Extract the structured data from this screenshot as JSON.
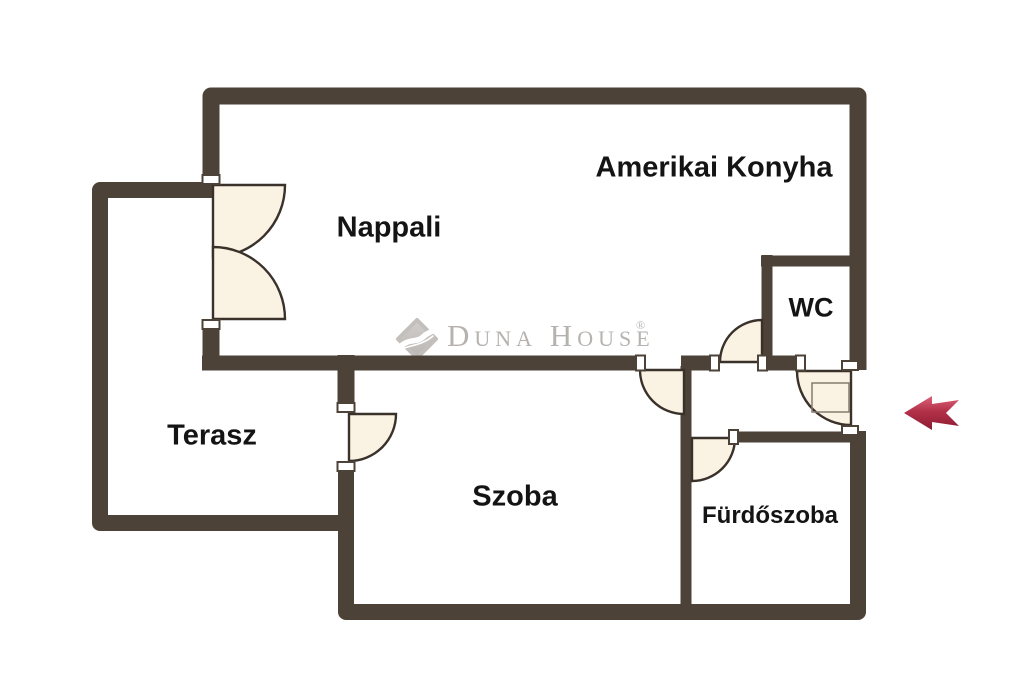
{
  "floorplan": {
    "rooms": [
      {
        "label": "Amerikai Konyha"
      },
      {
        "label": "Nappali"
      },
      {
        "label": "WC"
      },
      {
        "label": "Terasz"
      },
      {
        "label": "Szoba"
      },
      {
        "label": "Fürdőszoba"
      }
    ],
    "watermark": {
      "brand": "Duna House",
      "registered_mark": "®"
    },
    "entrance_arrow": {
      "direction": "left"
    },
    "colors": {
      "background": "#ffffff",
      "wall": "#4d4238",
      "door_fill": "#faf2e3",
      "door_stroke": "#39312a",
      "label_text": "#141414",
      "watermark_gray": "#b6b2af",
      "arrow_top": "#dd6276",
      "arrow_bottom": "#8c1c31"
    }
  }
}
